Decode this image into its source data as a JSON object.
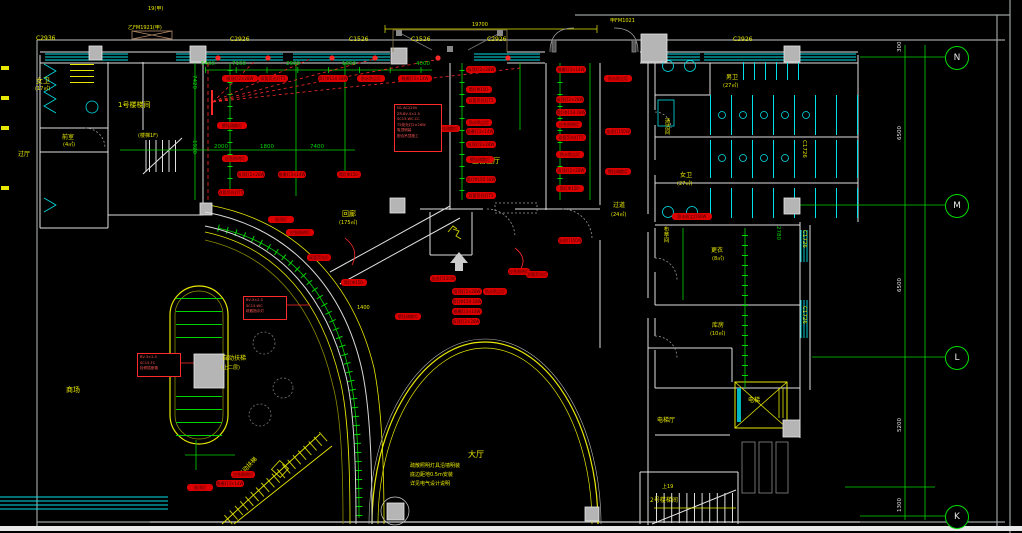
{
  "drawing": {
    "type_label": "首层照明平面图",
    "bottom_strip": ""
  },
  "colors": {
    "wall": "#e0e0e0",
    "window_cyan": "#00e0e8",
    "annotation_yellow": "#e8e800",
    "dimension_green": "#00d400",
    "tag_red": "#dd0000",
    "column_gray": "#b5b5b5",
    "frame_gray": "#9aa0a0"
  },
  "axis": {
    "bubbles": [
      {
        "letter": "N",
        "y": 46
      },
      {
        "letter": "M",
        "y": 194
      },
      {
        "letter": "L",
        "y": 346
      },
      {
        "letter": "K",
        "y": 505
      }
    ],
    "dims": [
      {
        "t": "300",
        "x": 898,
        "y": 52,
        "r": -90,
        "c": "w",
        "s": 5.5,
        "n": "axis-dimension"
      },
      {
        "t": "6500",
        "x": 898,
        "y": 140,
        "r": -90,
        "c": "w",
        "s": 5.5,
        "n": "axis-dimension"
      },
      {
        "t": "6500",
        "x": 898,
        "y": 292,
        "r": -90,
        "c": "w",
        "s": 5.5,
        "n": "axis-dimension"
      },
      {
        "t": "5200",
        "x": 898,
        "y": 432,
        "r": -90,
        "c": "w",
        "s": 5.5,
        "n": "axis-dimension"
      },
      {
        "t": "1300",
        "x": 898,
        "y": 512,
        "r": -90,
        "c": "w",
        "s": 5.5,
        "n": "axis-dimension"
      }
    ]
  },
  "texts": [
    {
      "t": "C2936",
      "x": 36,
      "y": 36,
      "c": "y",
      "s": 6,
      "n": "window-tag"
    },
    {
      "t": "C2926",
      "x": 230,
      "y": 37,
      "c": "y",
      "s": 6,
      "n": "window-tag"
    },
    {
      "t": "C1526",
      "x": 349,
      "y": 37,
      "c": "y",
      "s": 6,
      "n": "window-tag"
    },
    {
      "t": "C1526",
      "x": 411,
      "y": 37,
      "c": "y",
      "s": 6,
      "n": "window-tag"
    },
    {
      "t": "C2926",
      "x": 487,
      "y": 37,
      "c": "y",
      "s": 6,
      "n": "window-tag"
    },
    {
      "t": "C2926",
      "x": 733,
      "y": 37,
      "c": "y",
      "s": 6,
      "n": "window-tag"
    },
    {
      "t": "C1726",
      "x": 806,
      "y": 140,
      "r": 90,
      "c": "y",
      "s": 5.5,
      "n": "window-tag"
    },
    {
      "t": "C1726",
      "x": 806,
      "y": 230,
      "r": 90,
      "c": "y",
      "s": 5.5,
      "n": "window-tag"
    },
    {
      "t": "C1726",
      "x": 806,
      "y": 306,
      "r": 90,
      "c": "y",
      "s": 5.5,
      "n": "window-tag"
    },
    {
      "t": "女卫",
      "x": 36,
      "y": 78,
      "c": "y",
      "s": 7,
      "n": "room-label"
    },
    {
      "t": "(17㎡)",
      "x": 35,
      "y": 87,
      "c": "y",
      "s": 5,
      "n": "room-area"
    },
    {
      "t": "前室",
      "x": 62,
      "y": 135,
      "c": "y",
      "s": 6,
      "n": "room-label"
    },
    {
      "t": "(4㎡)",
      "x": 63,
      "y": 143,
      "c": "y",
      "s": 5,
      "n": "room-area"
    },
    {
      "t": "过厅",
      "x": 18,
      "y": 152,
      "c": "y",
      "s": 6,
      "n": "room-label"
    },
    {
      "t": "1号楼梯间",
      "x": 118,
      "y": 102,
      "c": "y",
      "s": 7,
      "n": "room-label"
    },
    {
      "t": "(楼梯1F)",
      "x": 138,
      "y": 134,
      "c": "y",
      "s": 5,
      "n": "room-area"
    },
    {
      "t": "男卫",
      "x": 726,
      "y": 75,
      "c": "y",
      "s": 6,
      "n": "room-label"
    },
    {
      "t": "(27㎡)",
      "x": 723,
      "y": 84,
      "c": "y",
      "s": 5,
      "n": "room-area"
    },
    {
      "t": "清洁间",
      "x": 663,
      "y": 118,
      "v": 1,
      "c": "y",
      "s": 5.5,
      "n": "room-label"
    },
    {
      "t": "女卫",
      "x": 680,
      "y": 173,
      "c": "y",
      "s": 6,
      "n": "room-label"
    },
    {
      "t": "(27㎡)",
      "x": 677,
      "y": 182,
      "c": "y",
      "s": 5,
      "n": "room-area"
    },
    {
      "t": "布草间",
      "x": 662,
      "y": 226,
      "v": 1,
      "c": "y",
      "s": 5.5,
      "n": "room-label"
    },
    {
      "t": "更衣",
      "x": 711,
      "y": 248,
      "c": "y",
      "s": 6,
      "n": "room-label"
    },
    {
      "t": "(8㎡)",
      "x": 712,
      "y": 257,
      "c": "y",
      "s": 5,
      "n": "room-area"
    },
    {
      "t": "库房",
      "x": 712,
      "y": 323,
      "c": "y",
      "s": 6,
      "n": "room-label"
    },
    {
      "t": "(10㎡)",
      "x": 710,
      "y": 332,
      "c": "y",
      "s": 5,
      "n": "room-area"
    },
    {
      "t": "电梯",
      "x": 748,
      "y": 398,
      "c": "y",
      "s": 6,
      "n": "room-label"
    },
    {
      "t": "电梯厅",
      "x": 657,
      "y": 418,
      "c": "y",
      "s": 6,
      "n": "room-label"
    },
    {
      "t": "上19",
      "x": 662,
      "y": 485,
      "c": "y",
      "s": 5,
      "n": "stair-note"
    },
    {
      "t": "2号楼梯间",
      "x": 650,
      "y": 498,
      "c": "y",
      "s": 6,
      "n": "room-label"
    },
    {
      "t": "回廊",
      "x": 342,
      "y": 211,
      "c": "y",
      "s": 7,
      "n": "room-label"
    },
    {
      "t": "(175㎡)",
      "x": 339,
      "y": 221,
      "c": "y",
      "s": 5,
      "n": "room-area"
    },
    {
      "t": "主营业厅",
      "x": 472,
      "y": 158,
      "c": "y",
      "s": 7,
      "n": "room-label"
    },
    {
      "t": "过道",
      "x": 613,
      "y": 203,
      "c": "y",
      "s": 6,
      "n": "room-label"
    },
    {
      "t": "(24㎡)",
      "x": 611,
      "y": 213,
      "c": "y",
      "s": 5,
      "n": "room-area"
    },
    {
      "t": "大厅",
      "x": 468,
      "y": 451,
      "c": "y",
      "s": 8,
      "n": "room-label"
    },
    {
      "t": "自动扶梯",
      "x": 222,
      "y": 356,
      "c": "y",
      "s": 6,
      "n": "room-label"
    },
    {
      "t": "(上二层)",
      "x": 221,
      "y": 366,
      "c": "y",
      "s": 5,
      "n": "room-area"
    },
    {
      "t": "商场",
      "x": 66,
      "y": 387,
      "c": "y",
      "s": 7,
      "n": "room-label"
    },
    {
      "t": "自动扶梯",
      "x": 238,
      "y": 474,
      "c": "y",
      "s": 6,
      "r": -47,
      "n": "escalator-label"
    },
    {
      "t": "乙FM1921(甲)",
      "x": 128,
      "y": 26,
      "c": "y",
      "s": 5,
      "n": "door-tag"
    },
    {
      "t": "19(甲)",
      "x": 148,
      "y": 7,
      "c": "y",
      "s": 5,
      "n": "door-tag"
    },
    {
      "t": "甲FM1021",
      "x": 610,
      "y": 19,
      "c": "y",
      "s": 5,
      "n": "door-tag"
    },
    {
      "t": "19700",
      "x": 472,
      "y": 23,
      "c": "y",
      "s": 5,
      "n": "dimension"
    },
    {
      "t": "疏散照明灯具沿墙明装",
      "x": 410,
      "y": 464,
      "c": "y",
      "s": 5,
      "n": "note-text"
    },
    {
      "t": "底边距地0.5m安装",
      "x": 410,
      "y": 473,
      "c": "y",
      "s": 5,
      "n": "note-text"
    },
    {
      "t": "详见电气设计说明",
      "x": 410,
      "y": 482,
      "c": "y",
      "s": 5,
      "n": "note-text"
    },
    {
      "t": "1400",
      "x": 357,
      "y": 306,
      "c": "y",
      "s": 5,
      "n": "dimension"
    },
    {
      "t": "5400",
      "x": 201,
      "y": 62,
      "c": "g",
      "s": 5.5,
      "n": "dimension"
    },
    {
      "t": "7100",
      "x": 232,
      "y": 62,
      "c": "g",
      "s": 5.5,
      "n": "dimension"
    },
    {
      "t": "2600",
      "x": 286,
      "y": 62,
      "c": "g",
      "s": 5.5,
      "n": "dimension"
    },
    {
      "t": "1650",
      "x": 342,
      "y": 62,
      "c": "g",
      "s": 5.5,
      "n": "dimension"
    },
    {
      "t": "4000",
      "x": 416,
      "y": 62,
      "c": "g",
      "s": 5.5,
      "n": "dimension"
    },
    {
      "t": "7900",
      "x": 274,
      "y": 78,
      "c": "g",
      "s": 5.5,
      "n": "dimension"
    },
    {
      "t": "2000",
      "x": 214,
      "y": 145,
      "c": "g",
      "s": 5.5,
      "n": "dimension"
    },
    {
      "t": "1800",
      "x": 260,
      "y": 145,
      "c": "g",
      "s": 5.5,
      "n": "dimension"
    },
    {
      "t": "7400",
      "x": 310,
      "y": 145,
      "c": "g",
      "s": 5.5,
      "n": "dimension"
    },
    {
      "t": "7420",
      "x": 196,
      "y": 75,
      "r": 90,
      "c": "g",
      "s": 5.5,
      "n": "dimension"
    },
    {
      "t": "1920",
      "x": 196,
      "y": 140,
      "r": 90,
      "c": "g",
      "s": 5.5,
      "n": "dimension"
    },
    {
      "t": "2780",
      "x": 780,
      "y": 226,
      "r": 90,
      "c": "g",
      "s": 5.5,
      "n": "dimension"
    }
  ],
  "tag_texts": [
    "吸顶灯2×28W",
    "双管荧光灯T5",
    "筒灯Φ150-18W",
    "防水防尘灯60W",
    "格栅灯3×14W",
    "壁挂疏散灯",
    "应急照明灯",
    "金卤灯150W"
  ],
  "tags": [
    [
      222,
      75,
      36,
      0
    ],
    [
      258,
      75,
      30,
      1
    ],
    [
      318,
      75,
      30,
      2
    ],
    [
      357,
      75,
      28,
      3
    ],
    [
      398,
      75,
      34,
      4
    ],
    [
      217,
      122,
      30,
      5
    ],
    [
      222,
      155,
      26,
      6
    ],
    [
      237,
      171,
      28,
      0
    ],
    [
      278,
      171,
      28,
      4
    ],
    [
      337,
      171,
      24,
      2
    ],
    [
      218,
      189,
      26,
      1
    ],
    [
      466,
      66,
      30,
      0
    ],
    [
      466,
      86,
      26,
      2
    ],
    [
      466,
      97,
      30,
      1
    ],
    [
      466,
      119,
      26,
      3
    ],
    [
      466,
      128,
      28,
      4
    ],
    [
      466,
      141,
      30,
      0
    ],
    [
      466,
      156,
      28,
      5
    ],
    [
      466,
      176,
      30,
      2
    ],
    [
      466,
      192,
      30,
      1
    ],
    [
      556,
      66,
      30,
      4
    ],
    [
      556,
      96,
      28,
      0
    ],
    [
      556,
      109,
      30,
      2
    ],
    [
      556,
      121,
      26,
      6
    ],
    [
      556,
      134,
      30,
      1
    ],
    [
      556,
      151,
      28,
      3
    ],
    [
      556,
      167,
      30,
      0
    ],
    [
      556,
      185,
      28,
      2
    ],
    [
      605,
      128,
      26,
      7
    ],
    [
      605,
      168,
      26,
      5
    ],
    [
      604,
      75,
      28,
      3
    ],
    [
      268,
      216,
      26,
      0
    ],
    [
      286,
      229,
      28,
      6
    ],
    [
      307,
      254,
      24,
      1
    ],
    [
      341,
      279,
      26,
      2
    ],
    [
      430,
      275,
      26,
      7
    ],
    [
      452,
      288,
      30,
      0
    ],
    [
      483,
      288,
      24,
      3
    ],
    [
      508,
      268,
      22,
      6
    ],
    [
      526,
      271,
      22,
      1
    ],
    [
      452,
      298,
      30,
      2
    ],
    [
      452,
      308,
      30,
      4
    ],
    [
      452,
      318,
      28,
      0
    ],
    [
      395,
      313,
      26,
      5
    ],
    [
      558,
      237,
      24,
      7
    ],
    [
      672,
      213,
      40,
      3
    ],
    [
      187,
      484,
      26,
      0
    ],
    [
      216,
      480,
      28,
      4
    ],
    [
      231,
      471,
      24,
      6
    ],
    [
      436,
      125,
      24,
      5
    ]
  ],
  "notes": [
    {
      "x": 394,
      "y": 104,
      "w": 42,
      "h": 44,
      "lines": [
        "N1 AC220V",
        "ZR-BV-3×2.5",
        "SC15-WC.CC",
        "T5荧光灯2×28W",
        "吸顶明装",
        "配合吊顶施工"
      ]
    },
    {
      "x": 243,
      "y": 296,
      "w": 38,
      "h": 20,
      "lines": [
        "BV-3×2.5",
        "SC15-WC",
        "疏散指示灯"
      ]
    },
    {
      "x": 137,
      "y": 353,
      "w": 38,
      "h": 20,
      "lines": [
        "BV-3×2.5",
        "SC15-FC",
        "检修插座箱"
      ]
    }
  ]
}
